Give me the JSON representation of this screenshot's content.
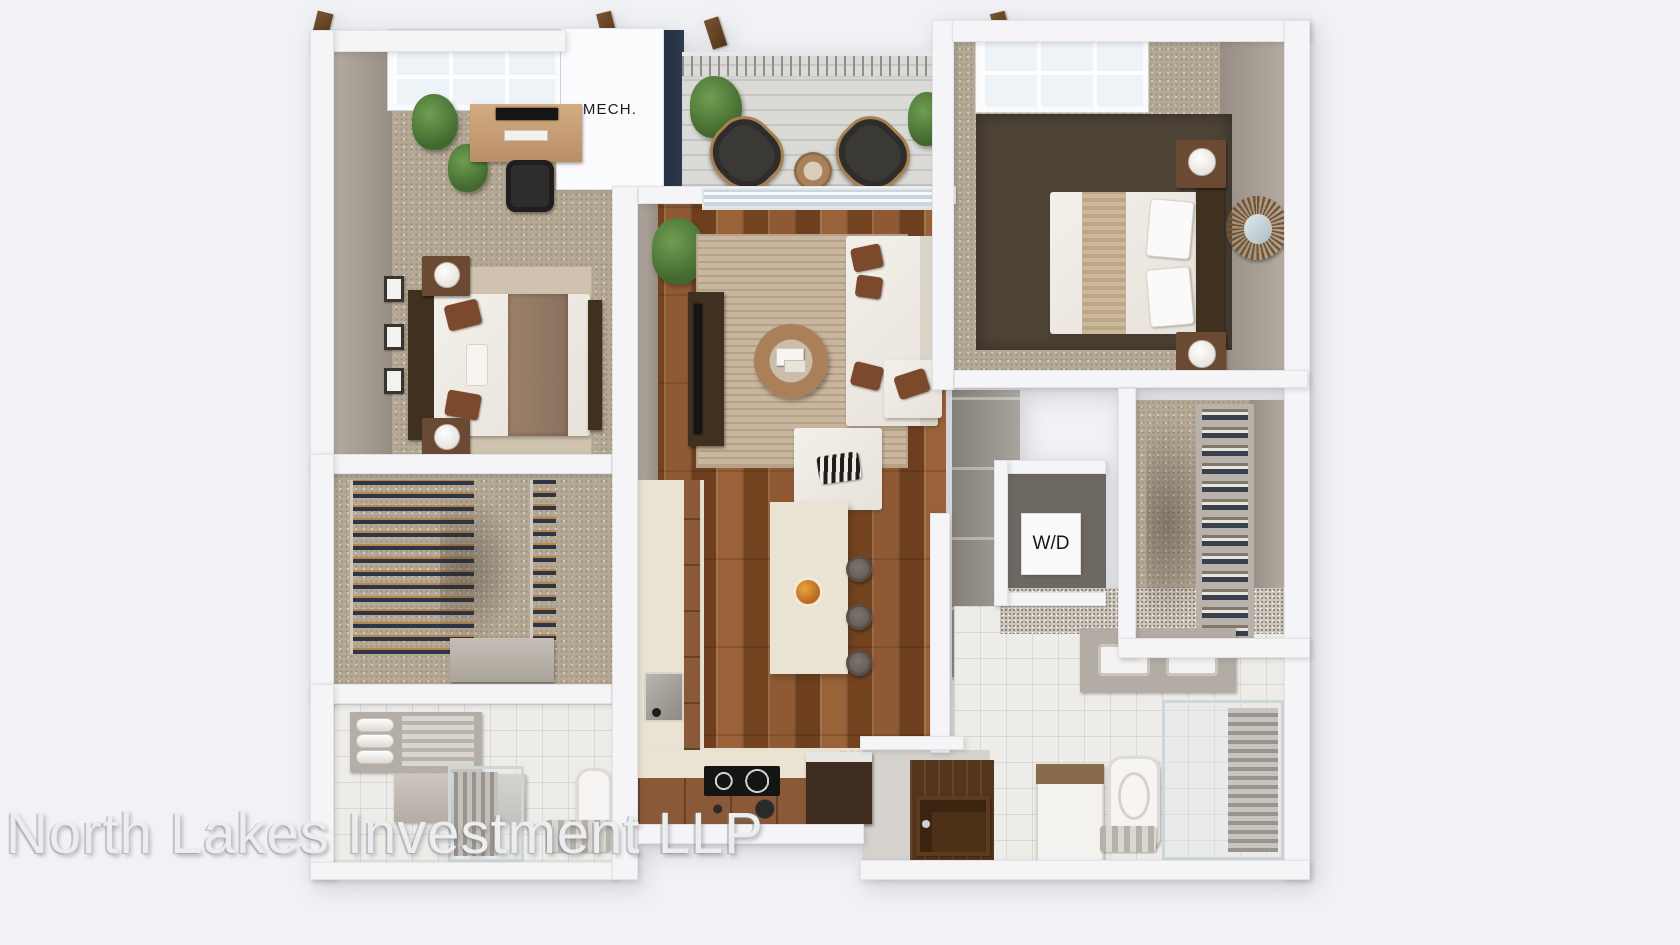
{
  "watermark": {
    "text": "North Lakes Investment LLP"
  },
  "labels": {
    "mech": "MECH.",
    "washer_dryer": "W/D"
  },
  "palette": {
    "background": "#f1f2f5",
    "wall": "#f5f5f7",
    "wall_face": "#968d85",
    "carpet": "#b5a996",
    "wood_dark": "#84542e",
    "wood_light": "#9a6238",
    "deck": "#dadad7",
    "tile_kitchen": "#e9e2d2",
    "tile_bath": "#edece8",
    "rug": "#c9b69e",
    "cabinet": "#8a5a38",
    "counter": "#eae3d3",
    "sofa": "#e7e2da",
    "pillow_brown": "#7b4a2c",
    "navy_wall": "#2e3a4d",
    "plant": "#41682e",
    "stool": "#665e56",
    "dark_wood": "#40301f",
    "door_wood": "#55351c",
    "glass": "#edf3f7",
    "watermark": "#ecedef",
    "label_text": "#1c1c1c"
  }
}
